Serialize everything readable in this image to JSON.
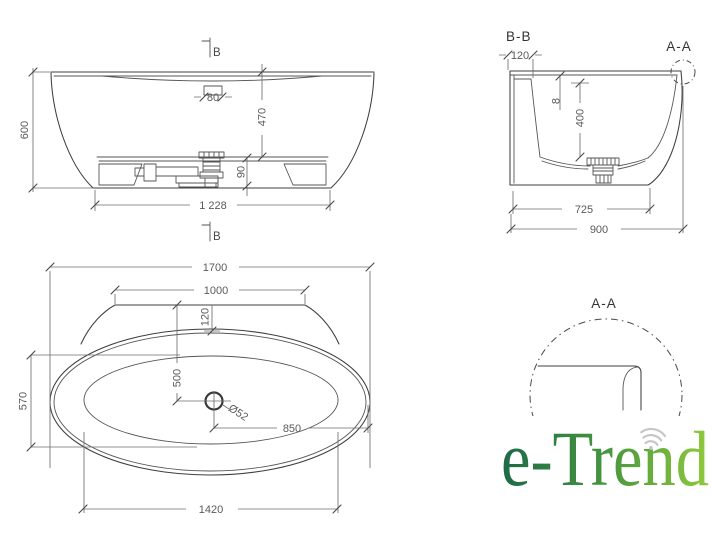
{
  "drawing": {
    "front_view": {
      "section_cut_top": "B",
      "section_cut_bottom": "B",
      "dim_height": "600",
      "dim_inner_depth": "470",
      "dim_overflow": "80",
      "dim_base_height": "90",
      "dim_base_length": "1 228"
    },
    "section_view": {
      "title": "B-B",
      "detail_label": "A-A",
      "dim_rim_edge": "120",
      "dim_wall": "8",
      "dim_inner_depth": "400",
      "dim_base_width": "725",
      "dim_overall_width": "900"
    },
    "plan_view": {
      "dim_overall_length": "1700",
      "dim_deck_width": "1000",
      "dim_rim_offset": "120",
      "dim_drain_from_deck": "500",
      "dim_drain_diameter": "Ø52",
      "dim_drain_offset": "850",
      "dim_inner_width": "570",
      "dim_inner_length": "1420"
    },
    "detail_view": {
      "title": "A-A"
    }
  },
  "logo": {
    "text": "e-Trend",
    "gradient_start": "#1d6a46",
    "gradient_mid": "#46953f",
    "gradient_end": "#8fc93c",
    "wifi_color": "#c6c6c6"
  },
  "colors": {
    "object_line": "#3f3f3f",
    "dim_line": "#6f6f6f",
    "dim_text": "#5a5a5a",
    "background": "#ffffff"
  }
}
